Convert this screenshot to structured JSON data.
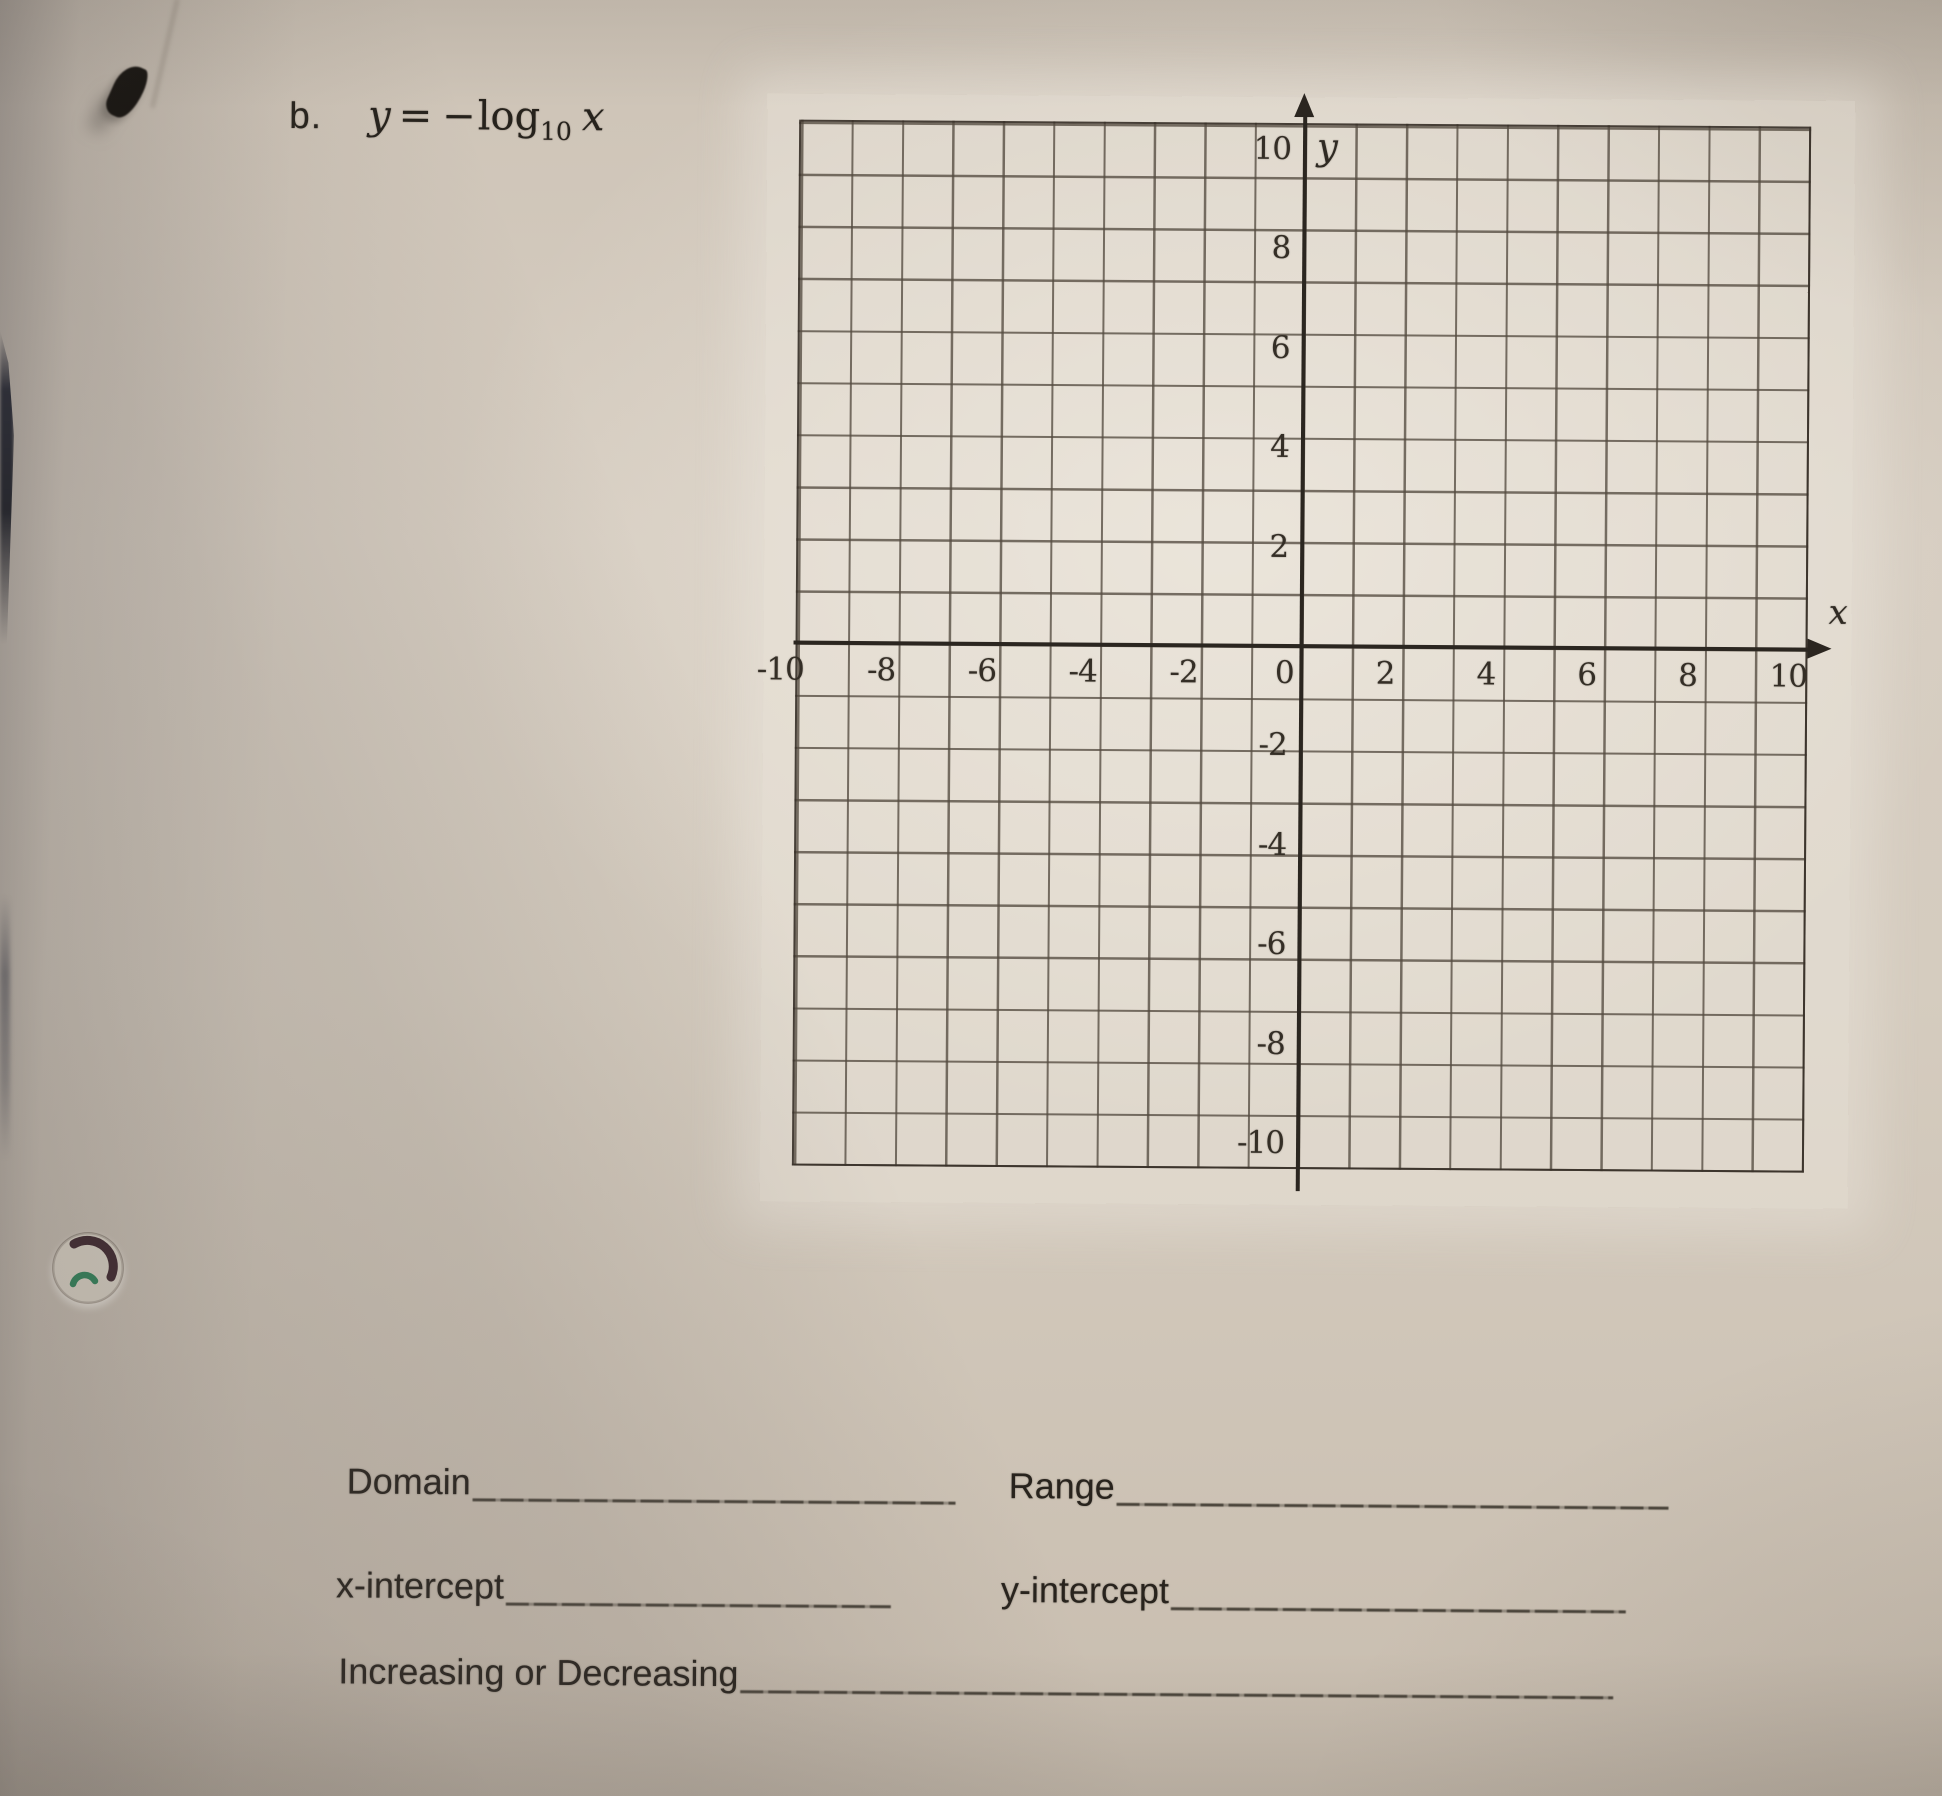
{
  "problem": {
    "letter": "b.",
    "eq_lhs": "y",
    "eq_rel": "=",
    "eq_neg": "−",
    "eq_fn": "log",
    "eq_sub": "10",
    "eq_arg": "x"
  },
  "graph": {
    "type": "blank-coordinate-grid",
    "x_axis_label": "x",
    "y_axis_label": "y",
    "x_ticks": [
      "-10",
      "-8",
      "-6",
      "-4",
      "-2",
      "0",
      "2",
      "4",
      "6",
      "8",
      "10"
    ],
    "y_ticks": [
      "10",
      "8",
      "6",
      "4",
      "2",
      "-2",
      "-4",
      "-6",
      "-8",
      "-10"
    ],
    "x_range": [
      -10,
      10
    ],
    "y_range": [
      -10,
      10
    ],
    "grid_cells_per_side": 20,
    "plotted_series": []
  },
  "fields": {
    "domain": "Domain",
    "range": "Range",
    "x_intercept": "x-intercept",
    "y_intercept": "y-intercept",
    "increasing": "Increasing or Decreasing"
  },
  "colors": {
    "paper": "#d5ccc0",
    "grid_line": "#554b40",
    "axis_ink": "#2b2620",
    "text_ink": "#28231d",
    "hole_dark_arc": "#3c262d",
    "hole_green_arc": "#2f8259"
  }
}
